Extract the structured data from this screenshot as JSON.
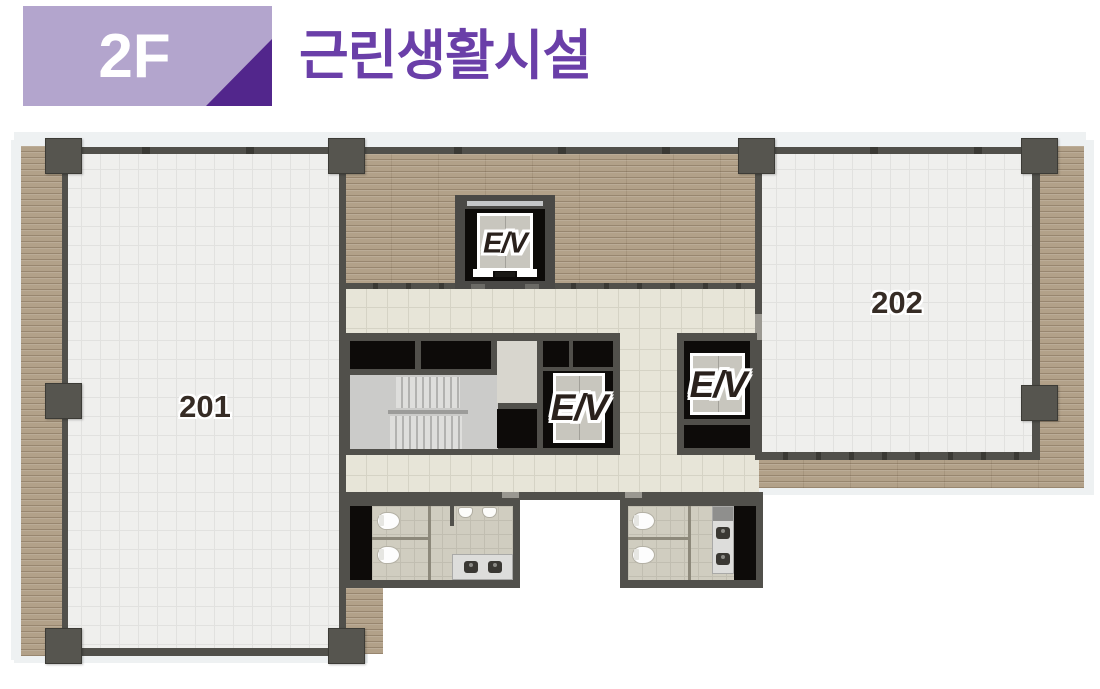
{
  "header": {
    "floor_label": "2F",
    "title": "근린생활시설",
    "colors": {
      "badge_bg": "#b3a5cd",
      "badge_triangle": "#52268c",
      "floor_label_text": "#ffffff",
      "title_text": "#6a3fa8"
    }
  },
  "floor_plan": {
    "type": "architectural-floor-plan",
    "floor": "2F",
    "use": "근린생활시설",
    "rooms": [
      {
        "label": "201"
      },
      {
        "label": "202"
      }
    ],
    "elevators": [
      {
        "id": "top",
        "label": "E/V"
      },
      {
        "id": "middle",
        "label": "E/V"
      },
      {
        "id": "right",
        "label": "E/V"
      }
    ],
    "features": [
      "stairwell",
      "restroom-left",
      "restroom-right",
      "wood-deck",
      "corridor"
    ],
    "colors": {
      "wall": "#51504b",
      "column": "#56554f",
      "wood_deck": "#b2a189",
      "room_tile": "#efefed",
      "corridor_tile": "#e7e5d8",
      "shaft_black": "#0d0b09",
      "stair_floor": "#cbcbc9",
      "restroom_tile": "#d0cdc0",
      "room_label_text": "#362c25"
    }
  }
}
